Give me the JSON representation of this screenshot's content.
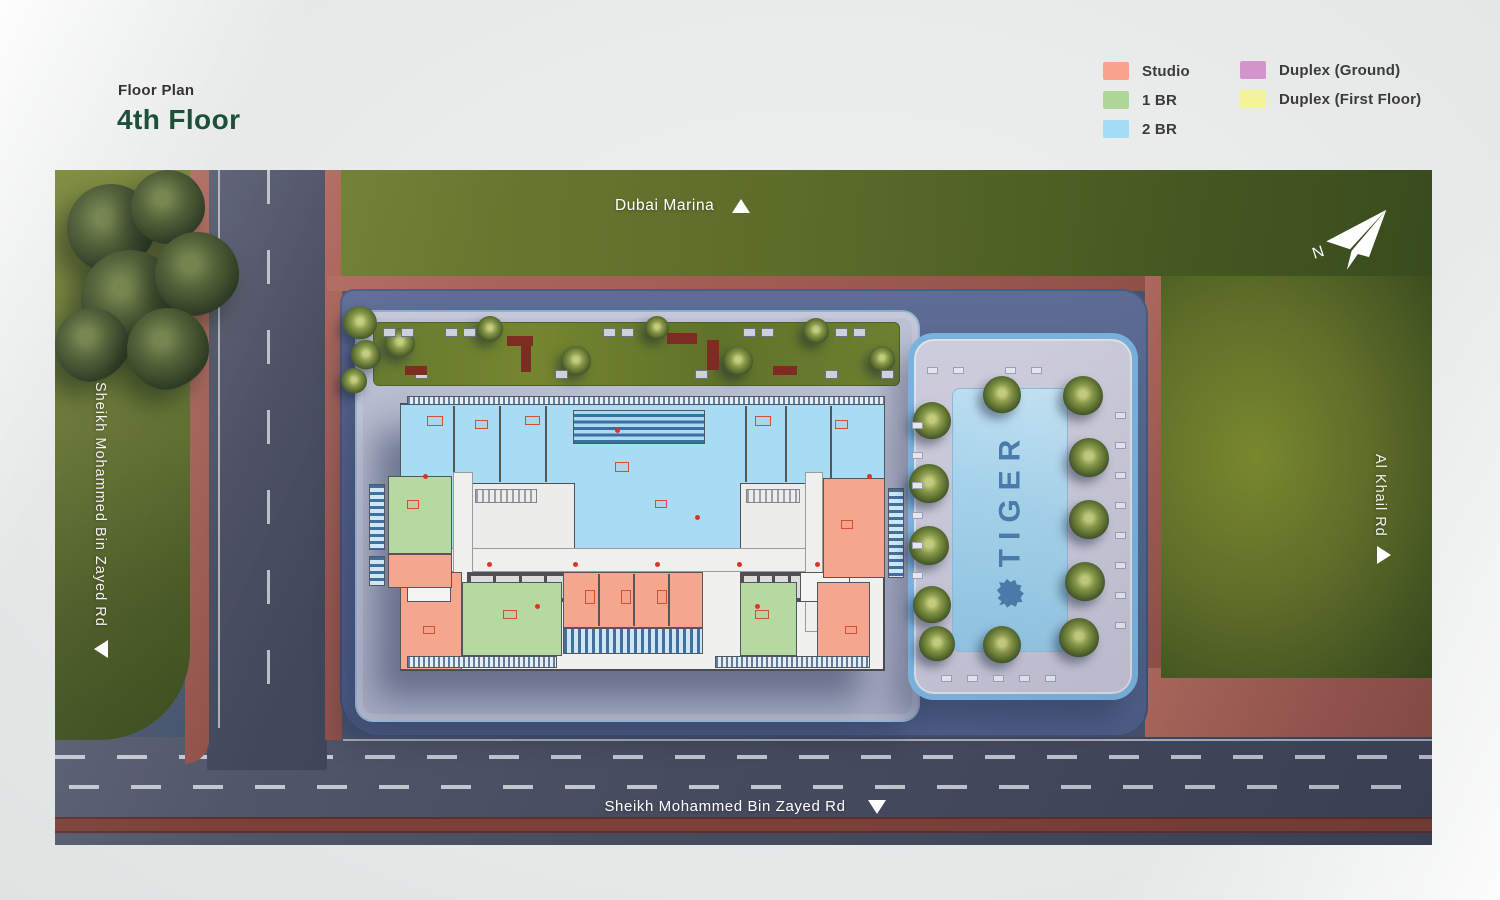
{
  "header": {
    "label": "Floor Plan",
    "title": "4th Floor"
  },
  "legend": {
    "items": [
      {
        "label": "Studio",
        "color": "#F9A28E"
      },
      {
        "label": "1 BR",
        "color": "#AED696"
      },
      {
        "label": "2 BR",
        "color": "#A5DDF7"
      },
      {
        "label": "Duplex (Ground)",
        "color": "#D495CD"
      },
      {
        "label": "Duplex (First Floor)",
        "color": "#F3F398"
      }
    ]
  },
  "map": {
    "road_labels": {
      "top": "Dubai Marina",
      "left": "Sheikh Mohammed Bin Zayed Rd",
      "right": "Al Khail Rd",
      "bottom": "Sheikh Mohammed Bin Zayed Rd"
    },
    "compass": {
      "letter": "N"
    },
    "pool_brand": "TIGER"
  },
  "colors": {
    "title_green": "#1D4F39",
    "studio": "#F9A28E",
    "one_br": "#AED696",
    "two_br": "#A5DDF7",
    "duplex_ground": "#D495CD",
    "duplex_first": "#F3F398",
    "grass": "#5C6E26",
    "road": "#474B5E",
    "sidewalk": "#A7625A",
    "parcel": "#56668E",
    "pool": "#9CCAE6",
    "pool_text": "#4A7CAB"
  }
}
